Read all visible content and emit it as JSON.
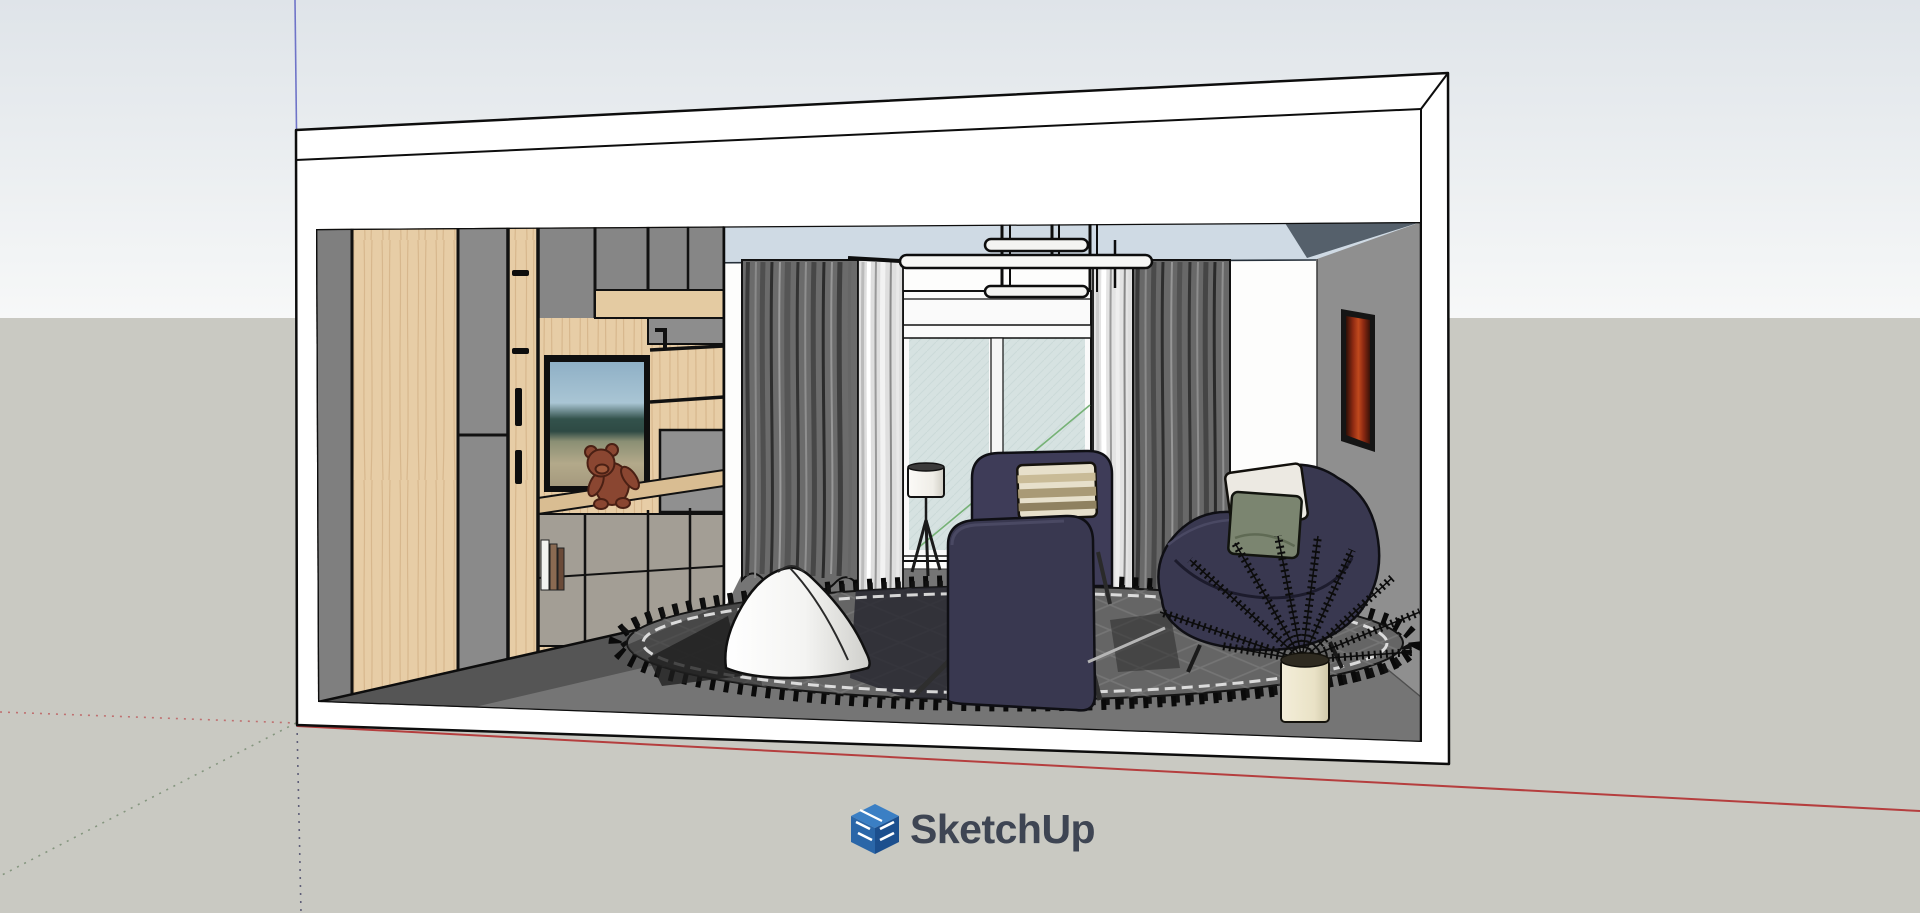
{
  "branding": {
    "logo_text": "SketchUp",
    "logo_icon": "sketchup-cube-icon",
    "text_color": "#3e4553",
    "logo_blue_top": "#3b7fc4",
    "logo_blue_left": "#2a66a8",
    "logo_blue_right": "#1c4f8e"
  },
  "viewport": {
    "description": "SketchUp 3D viewport showing a sectioned living-room interior model",
    "axes": {
      "red_solid": "#b53e3e",
      "red_dotted": "#bf7070",
      "green_dotted": "#85967f",
      "blue_solid": "#6f74c8",
      "blue_dotted": "#5f5f78"
    }
  },
  "scene": {
    "objects": [
      "room-shell",
      "ceiling",
      "ceiling-light-fixture",
      "left-wardrobe-unit",
      "tv-screen",
      "teddy-bear",
      "books",
      "left-curtain",
      "right-curtain",
      "window-glass-doors",
      "floor-lamp",
      "white-pouf",
      "area-rug",
      "navy-sofa",
      "navy-armchair",
      "striped-pillow",
      "curved-lounge-chair",
      "white-pillow",
      "green-pillow",
      "fern-plant",
      "plant-pot",
      "wall-art-frame",
      "gray-right-wall",
      "dark-floor"
    ],
    "palette": {
      "sky_top": "#dfe4e9",
      "sky_horizon": "#f7f8f8",
      "ground": "#c9c9c2",
      "shell_white": "#ffffff",
      "ceiling_blue": "#cfdae4",
      "wall_gray": "#909090",
      "floor_gray": "#757575",
      "rug_gray": "#656565",
      "wood_light": "#e7cda6",
      "cabinet_gray": "#8b8b8b",
      "navy_fabric": "#393850",
      "curtain_gray": "#6b6b6b",
      "glass_tint": "#d6e2e1",
      "pouf_white": "#f6f6f4",
      "pot_cream": "#ece5cc",
      "art_red": "#c1491d",
      "bear_brown": "#8a4631"
    }
  }
}
